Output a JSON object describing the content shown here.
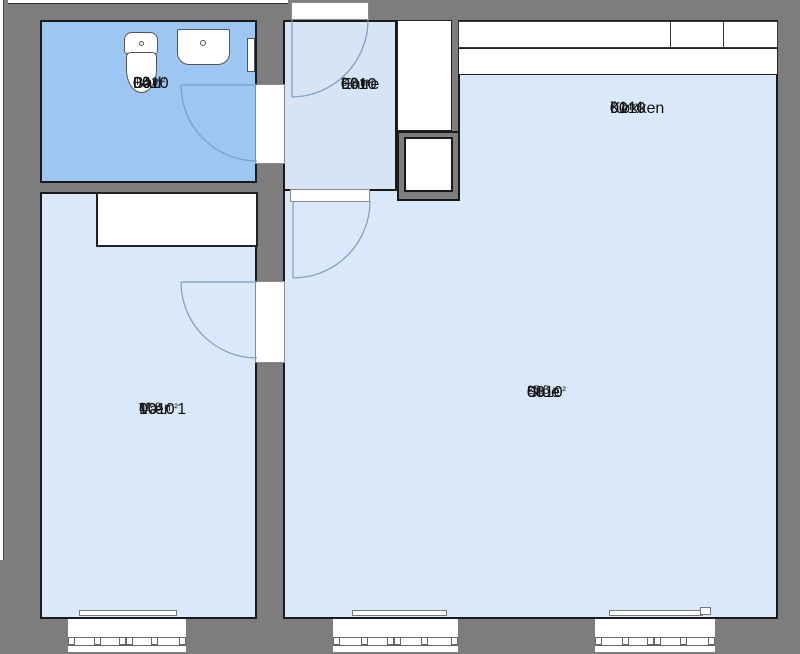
{
  "plan": {
    "unit_id": "0010",
    "rooms": [
      {
        "key": "kokken",
        "unit": "0010",
        "number": "01",
        "name": "Køkken",
        "area": "7.1 m²"
      },
      {
        "key": "bad",
        "unit": "0010",
        "number": "04",
        "name": "Bad",
        "area": "4.9 m²"
      },
      {
        "key": "entre",
        "unit": "0010",
        "number": "06",
        "name": "Entre",
        "area": "3.2 m²"
      },
      {
        "key": "stue",
        "unit": "0010",
        "number": "08",
        "name": "Stue",
        "area": "25.5 m²"
      },
      {
        "key": "vaer1",
        "unit": "0010",
        "number": "10",
        "name": "Vær. 1",
        "area": "12.8 m²"
      }
    ],
    "colors": {
      "wall": "#7d7d7d",
      "outline": "#1a1a1a",
      "bathroom_fill": "#9dc6f2",
      "room_fill": "#dbe8fa",
      "entre_fill": "#d6e4f6",
      "fixture_fill": "#ffffff",
      "door_swing": "#7d9cc0",
      "text": "#111111"
    }
  }
}
